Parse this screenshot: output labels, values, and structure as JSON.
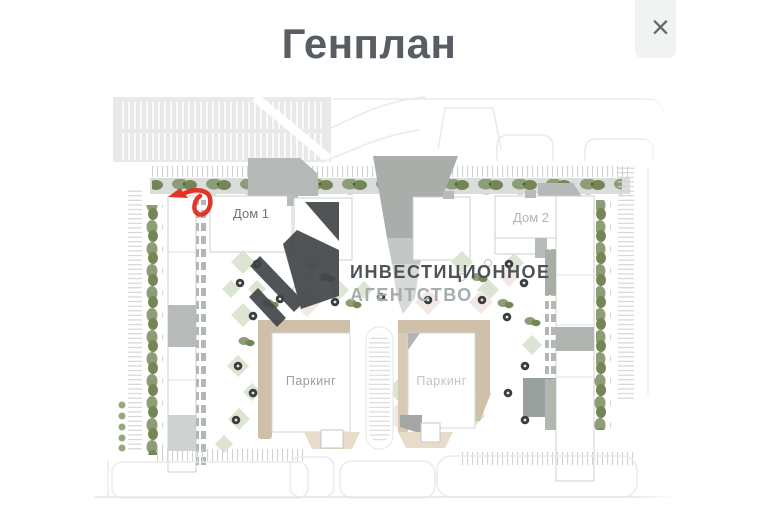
{
  "header": {
    "title": "Генплан",
    "close_label": "×"
  },
  "plan": {
    "buildings": {
      "dom1": "Дом 1",
      "dom2": "Дом 2"
    },
    "parking": {
      "left": "Паркинг",
      "right": "Паркинг"
    },
    "watermark": {
      "line1": "ИНВЕСТИЦИОННОЕ",
      "line2": "АГЕНТСТВО"
    },
    "colors": {
      "annotation_red": "#e23427",
      "watermark_dark": "#3e4245",
      "building_tan": "#cfc0aa",
      "lawn_green": "#dce5d1",
      "title_gray": "#575d62"
    }
  }
}
